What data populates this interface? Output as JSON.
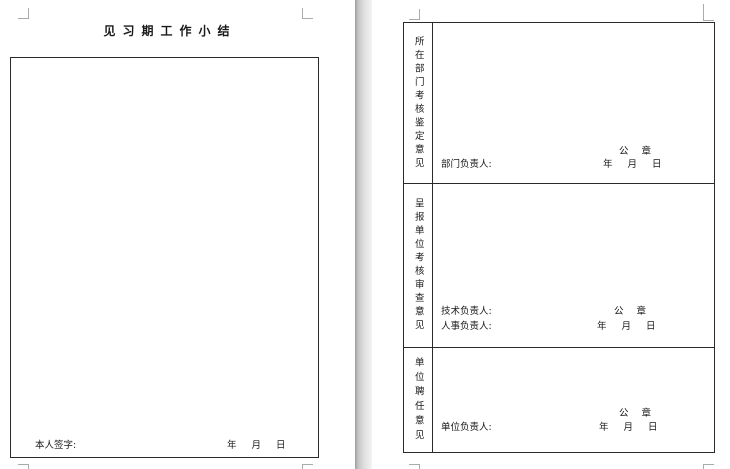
{
  "left_page": {
    "title": "见习期工作小结",
    "signature_label": "本人签字:",
    "date_line": "年 月 日"
  },
  "right_page": {
    "sections": [
      {
        "label": "所在部门考核鉴定意见",
        "seal": "公 章",
        "date_line": "年 月 日",
        "signers": [
          "部门负责人:"
        ]
      },
      {
        "label": "呈报单位考核审查意见",
        "seal": "公 章",
        "date_line": "年 月 日",
        "signers": [
          "技术负责人:",
          "人事负责人:"
        ]
      },
      {
        "label": "单位聘任意见",
        "seal": "公 章",
        "date_line": "年 月 日",
        "signers": [
          "单位负责人:"
        ]
      }
    ]
  },
  "colors": {
    "page_background": "#ffffff",
    "table_border": "#2a2a2a",
    "margin_marks": "#ababab",
    "gap_shadow": "#9e9e9e"
  }
}
